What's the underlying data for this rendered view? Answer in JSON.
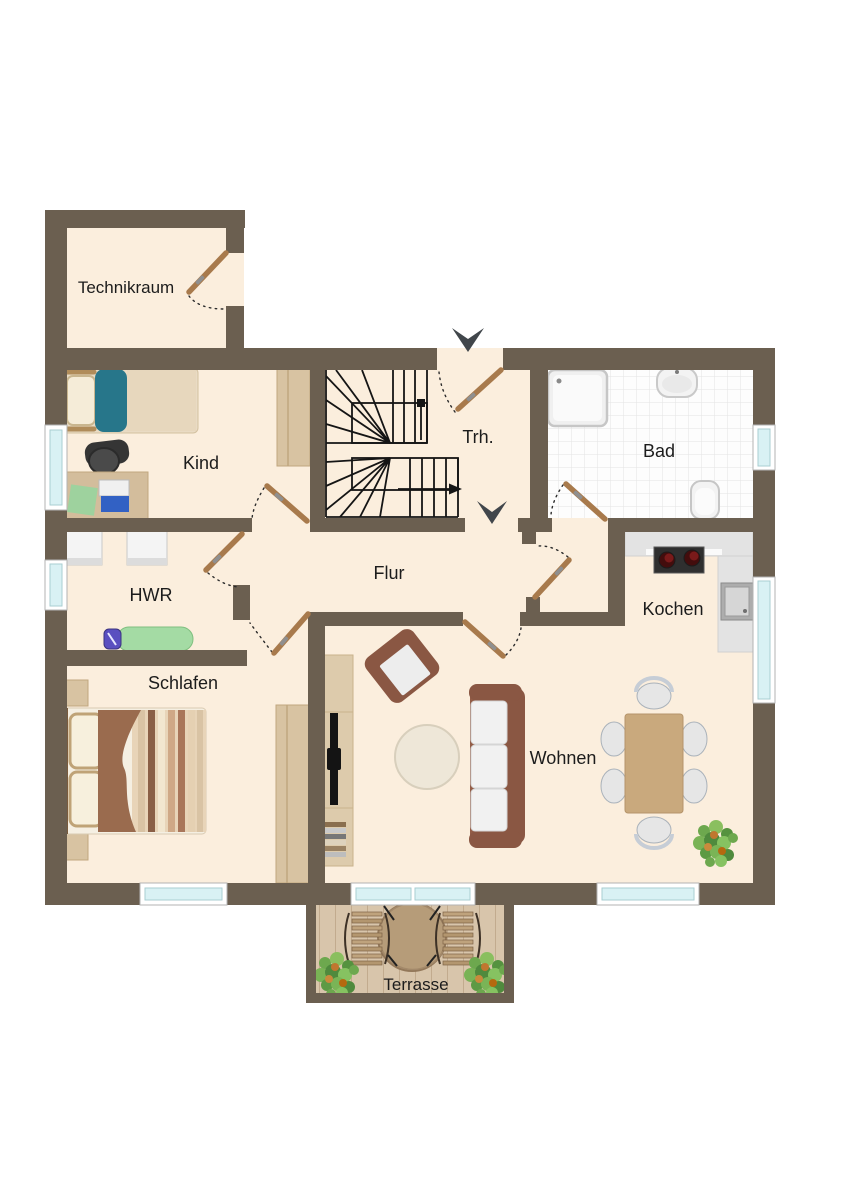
{
  "plan": {
    "rooms": [
      {
        "id": "technikraum",
        "label": "Technikraum"
      },
      {
        "id": "kind",
        "label": "Kind"
      },
      {
        "id": "treppenhaus",
        "label": "Trh."
      },
      {
        "id": "bad",
        "label": "Bad"
      },
      {
        "id": "hwr",
        "label": "HWR"
      },
      {
        "id": "flur",
        "label": "Flur"
      },
      {
        "id": "kochen",
        "label": "Kochen"
      },
      {
        "id": "schlafen",
        "label": "Schlafen"
      },
      {
        "id": "wohnen",
        "label": "Wohnen"
      },
      {
        "id": "terrasse",
        "label": "Terrasse"
      }
    ],
    "colors": {
      "wall": "#6b5f50",
      "floor": "#fbeedd",
      "tile_floor": "#fdfdfd",
      "window_glass": "#d9f1f4",
      "door_leaf": "#a87a4c",
      "deck": "#d8c5ab",
      "stair_lines": "#151515",
      "direction_arrow": "#41464b"
    }
  }
}
